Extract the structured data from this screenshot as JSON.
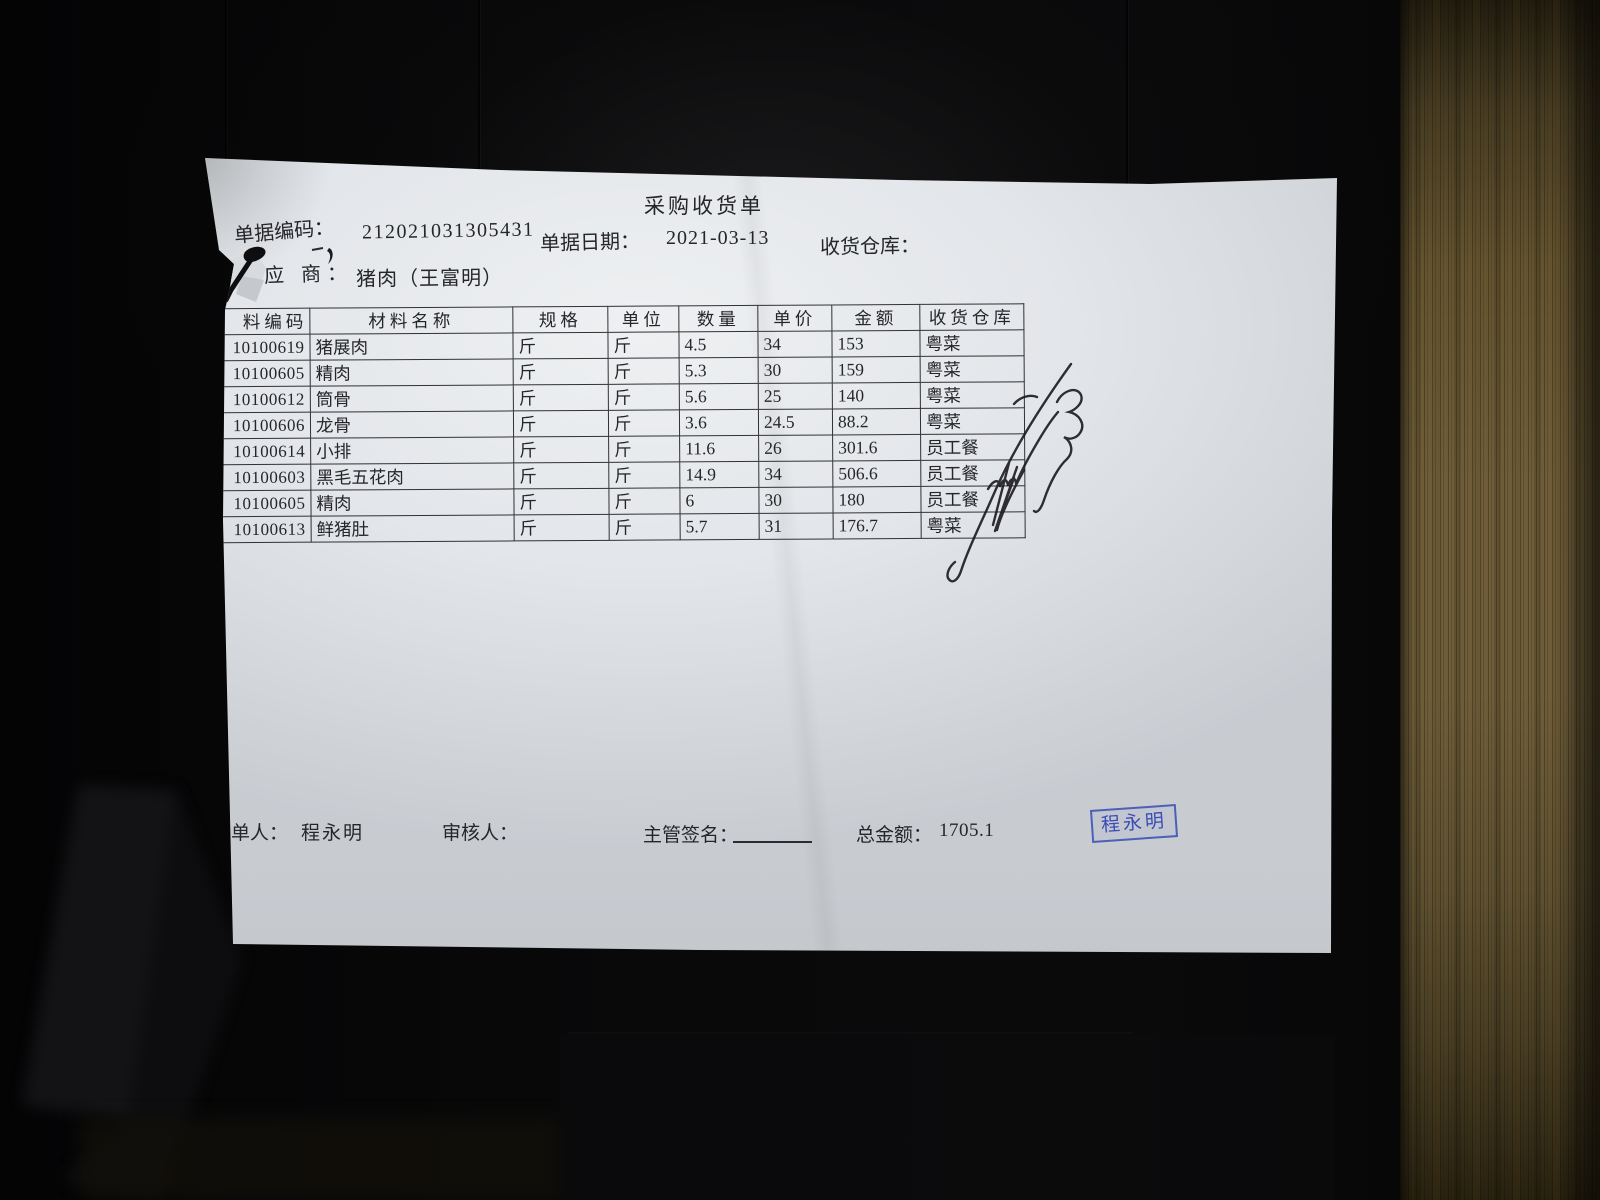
{
  "scene": {
    "description": "photo of a printed purchase receipt lying on a dark surface beside a wooden door frame",
    "colors": {
      "background": "#060607",
      "wood": "#6e5d38",
      "paper": "#e3e6ea",
      "print_ink": "#26262a",
      "stamp_blue": "#3a4cb4",
      "pen_ink": "#1a1a20"
    }
  },
  "document": {
    "title": "采购收货单",
    "header": {
      "doc_code_label": "单据编码：",
      "doc_code": "212021031305431",
      "doc_date_label": "单据日期：",
      "doc_date": "2021-03-13",
      "warehouse_label": "收货仓库：",
      "warehouse_value": "",
      "supplier_label": "应 商：",
      "supplier_value": "猪肉（王富明）"
    },
    "table": {
      "headers": [
        "料编码",
        "材料名称",
        "规格",
        "单位",
        "数量",
        "单价",
        "金额",
        "收货仓库"
      ],
      "rows": [
        [
          "10100619",
          "猪展肉",
          "斤",
          "斤",
          "4.5",
          "34",
          "153",
          "粤菜"
        ],
        [
          "10100605",
          "精肉",
          "斤",
          "斤",
          "5.3",
          "30",
          "159",
          "粤菜"
        ],
        [
          "10100612",
          "筒骨",
          "斤",
          "斤",
          "5.6",
          "25",
          "140",
          "粤菜"
        ],
        [
          "10100606",
          "龙骨",
          "斤",
          "斤",
          "3.6",
          "24.5",
          "88.2",
          "粤菜"
        ],
        [
          "10100614",
          "小排",
          "斤",
          "斤",
          "11.6",
          "26",
          "301.6",
          "员工餐"
        ],
        [
          "10100603",
          "黑毛五花肉",
          "斤",
          "斤",
          "14.9",
          "34",
          "506.6",
          "员工餐"
        ],
        [
          "10100605",
          "精肉",
          "斤",
          "斤",
          "6",
          "30",
          "180",
          "员工餐"
        ],
        [
          "10100613",
          "鲜猪肚",
          "斤",
          "斤",
          "5.7",
          "31",
          "176.7",
          "粤菜"
        ]
      ]
    },
    "footer": {
      "preparer_label": "单人：",
      "preparer": "程永明",
      "reviewer_label": "审核人：",
      "reviewer": "",
      "manager_sign_label": "主管签名：",
      "total_label": "总金额：",
      "total": "1705.1",
      "stamp_text": "程永明"
    }
  }
}
